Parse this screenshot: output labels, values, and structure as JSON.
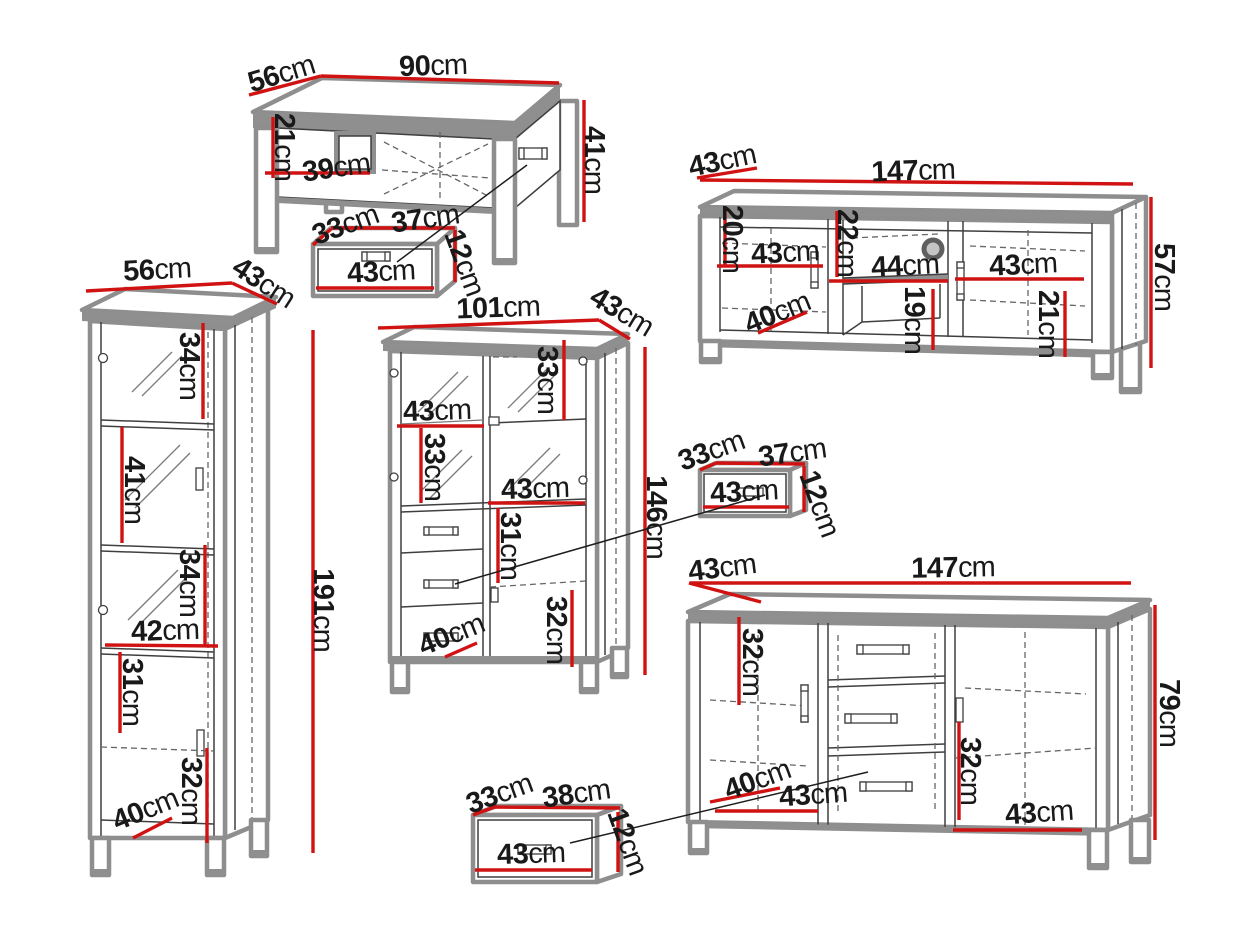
{
  "unit": "cm",
  "colors": {
    "dimension_red": "#d11212",
    "outline_gray": "#8e8e8e",
    "detail_dark": "#3f3f3f",
    "background": "#ffffff"
  },
  "furniture": {
    "coffee_table": {
      "label": "coffee table",
      "width": "90",
      "depth": "56",
      "height": "41",
      "inner_height": "21",
      "inner_width": "39"
    },
    "drawer_box_top": {
      "label": "drawer box",
      "depth": "33",
      "width": "37",
      "height": "12",
      "front_width": "43"
    },
    "tv_stand": {
      "label": "tv stand",
      "depth": "43",
      "width": "147",
      "height": "57",
      "left_inner_height": "20",
      "left_inner_width": "43",
      "mid_inner_height": "22",
      "mid_inner_width": "44",
      "right_inner_width": "43",
      "inner_depth": "40",
      "mid_lower_height": "19",
      "right_inner_height": "21"
    },
    "tall_cabinet": {
      "label": "tall display cabinet",
      "width": "56",
      "depth": "43",
      "height": "191",
      "top_section_height": "34",
      "second_section_height": "41",
      "third_section_height": "34",
      "inner_width": "42",
      "fourth_section_height": "31",
      "bottom_section_height": "32",
      "inner_depth": "40"
    },
    "display_cabinet": {
      "label": "display cabinet with drawers",
      "width": "101",
      "depth": "43",
      "height": "146",
      "left_inner_width": "43",
      "right_upper_height": "33",
      "left_inner_height": "33",
      "mid_inner_width": "43",
      "mid_inner_height": "31",
      "right_lower_height": "32",
      "inner_depth": "40"
    },
    "drawer_box_middle": {
      "label": "drawer box",
      "depth": "33",
      "width": "37",
      "height": "12",
      "front_width": "43"
    },
    "sideboard": {
      "label": "sideboard",
      "depth": "43",
      "width": "147",
      "height": "79",
      "left_inner_height": "32",
      "inner_depth": "40",
      "left_inner_width": "43",
      "right_inner_height": "32",
      "right_inner_width": "43"
    },
    "drawer_box_bottom": {
      "label": "drawer box",
      "depth": "33",
      "width": "38",
      "height": "12",
      "front_width": "43"
    }
  }
}
